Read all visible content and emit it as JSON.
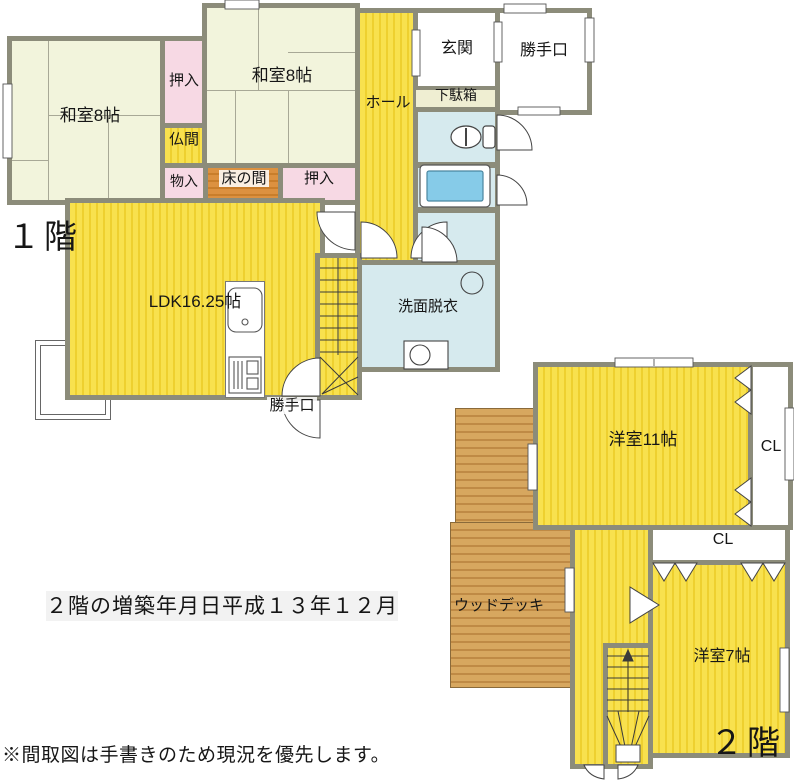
{
  "floorplan": {
    "floor1": {
      "label": "１階",
      "washitsu_left": "和室8帖",
      "oshiire_top": "押入",
      "washitsu_top": "和室8帖",
      "butsuma": "仏間",
      "monoire": "物入",
      "tokonoma": "床の間",
      "oshiire_right": "押入",
      "hall": "ホール",
      "genkan": "玄関",
      "katteguchi_room": "勝手口",
      "getabako": "下駄箱",
      "ldk": "LDK16.25帖",
      "senmen_datsui": "洗面脱衣",
      "katteguchi_door": "勝手口"
    },
    "floor2": {
      "label": "２階",
      "yoshitsu_11": "洋室11帖",
      "closet_1": "CL",
      "closet_2": "CL",
      "wood_deck": "ウッドデッキ",
      "yoshitsu_7": "洋室7帖"
    },
    "notes": {
      "extension_date": "２階の増築年月日平成１３年１２月",
      "disclaimer": "※間取図は手書きのため現況を優先します。"
    },
    "colors": {
      "room_yellow": "#f7dd41",
      "tatami_cream": "#f2f4dc",
      "closet_pink": "#f7d9e4",
      "tokonoma_orange": "#dc9140",
      "deck_brown": "#cf9c55",
      "wet_area_blue": "#d6eaee",
      "bathtub_blue": "#86cbe8",
      "wall_gray": "#8c8c7a"
    }
  }
}
